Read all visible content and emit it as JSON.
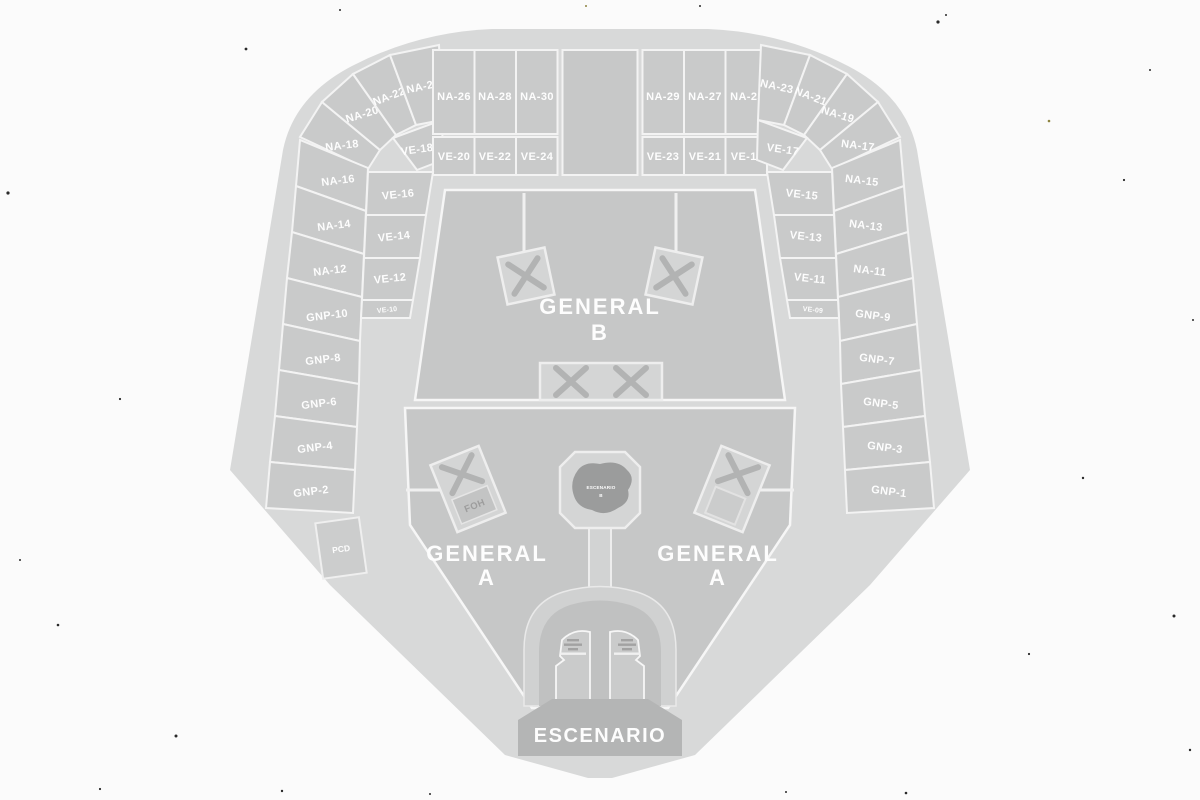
{
  "colors": {
    "background": "#fbfbfb",
    "venue_base": "#d8d9d9",
    "section_fill": "#c9caca",
    "field_fill": "#c6c7c7",
    "divider": "#f3f3f3",
    "stage_fill": "#b4b5b5",
    "label_text": "#fdfdfd",
    "x_mark": "#b2b3b3",
    "b_stage_blob": "#9b9c9c"
  },
  "sections": {
    "top_left_fan": [
      "NA-18",
      "NA-20",
      "NA-22",
      "NA-24"
    ],
    "top_left_fan_ve": "VE-18",
    "top_left_grid_na": [
      "NA-26",
      "NA-28",
      "NA-30"
    ],
    "top_left_grid_ve": [
      "VE-20",
      "VE-22",
      "VE-24"
    ],
    "top_right_grid_na": [
      "NA-29",
      "NA-27",
      "NA-25"
    ],
    "top_right_grid_ve": [
      "VE-23",
      "VE-21",
      "VE-19"
    ],
    "top_right_fan": [
      "NA-23",
      "NA-21",
      "NA-19",
      "NA-17"
    ],
    "top_right_fan_ve": "VE-17",
    "left_column": [
      "NA-16",
      "NA-14",
      "NA-12",
      "GNP-10",
      "GNP-8",
      "GNP-6",
      "GNP-4",
      "GNP-2"
    ],
    "left_ve": [
      "VE-16",
      "VE-14",
      "VE-12",
      "VE-10"
    ],
    "right_column": [
      "NA-15",
      "NA-13",
      "NA-11",
      "GNP-9",
      "GNP-7",
      "GNP-5",
      "GNP-3",
      "GNP-1"
    ],
    "right_ve": [
      "VE-15",
      "VE-13",
      "VE-11",
      "VE-09"
    ]
  },
  "fields": {
    "general_b_line1": "GENERAL",
    "general_b_line2": "B",
    "general_a_line1": "GENERAL",
    "general_a_line2": "A"
  },
  "stage": {
    "label": "ESCENARIO"
  },
  "b_stage": {
    "line1": "ESCENARIO",
    "line2": "B"
  },
  "platforms": {
    "foh": "FOH",
    "pcd": "PCD"
  }
}
